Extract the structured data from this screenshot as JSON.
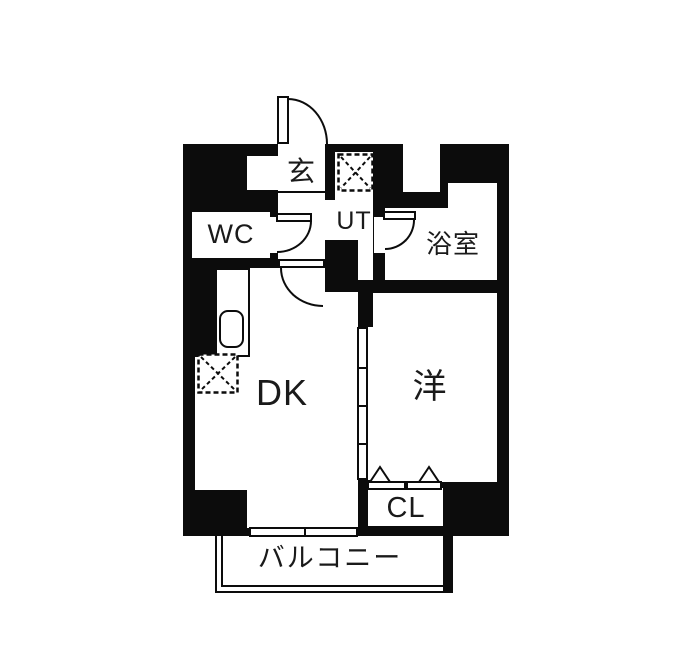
{
  "floorplan": {
    "title": "apartment-floor-plan-1dk",
    "rooms": {
      "entrance": {
        "label": "玄"
      },
      "toilet": {
        "label": "WC"
      },
      "utility": {
        "label": "UT"
      },
      "bathroom": {
        "label": "浴室"
      },
      "dining_kitchen": {
        "label": "DK"
      },
      "western_room": {
        "label": "洋"
      },
      "closet": {
        "label": "CL"
      },
      "balcony": {
        "label": "バルコニー"
      }
    },
    "colors": {
      "wall": "#0c0c0c",
      "floor": "#ffffff",
      "background": "#ffffff",
      "text": "#1a1a1a"
    }
  }
}
